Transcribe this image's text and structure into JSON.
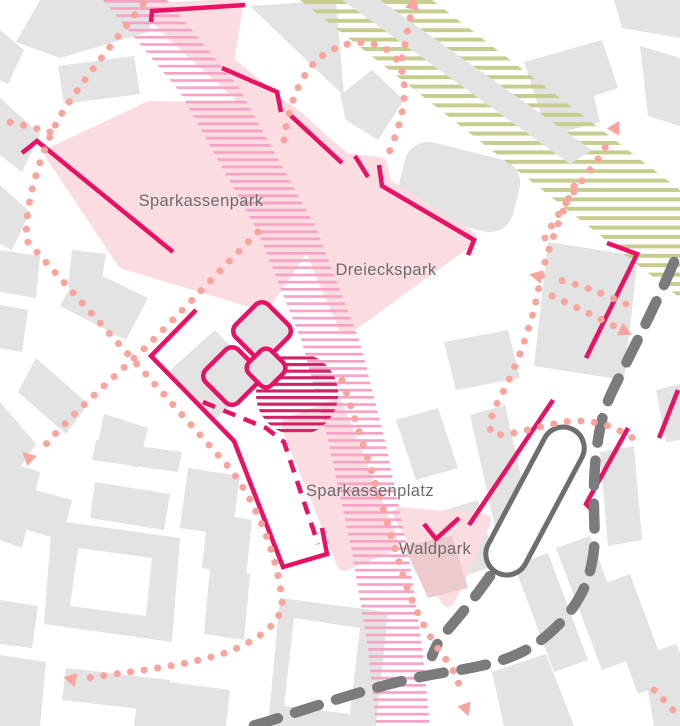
{
  "map": {
    "title": "Urban design site plan",
    "labels": [
      {
        "name": "sparkassenpark-label",
        "text": "Sparkassenpark"
      },
      {
        "name": "dreieckspark-label",
        "text": "Dreieckspark"
      },
      {
        "name": "sparkassenplatz-label",
        "text": "Sparkassenplatz"
      },
      {
        "name": "waldpark-label",
        "text": "Waldpark"
      }
    ],
    "features": {
      "parks": [
        "Sparkassenpark",
        "Dreieckspark",
        "Sparkassenplatz",
        "Waldpark"
      ],
      "pedestrian_band": "pink hatched promenade",
      "rail_band": "olive hatched corridor",
      "tram_platform": "rounded platform outline",
      "transit_route": "gray dashed line",
      "walking_routes": "salmon dotted arrows",
      "active_frontages": "magenta edge lines",
      "pavilions": "three rotated squares",
      "focus_area": "dark pink hatched circle"
    },
    "colors": {
      "building_gray": "#e3e3e4",
      "park_pink": "#fbdce1",
      "waldpark_mauve": "#eccacd",
      "accent_magenta": "#ea1164",
      "hatch_pink": "#f6a3c5",
      "hatch_dark_pink": "#ce2166",
      "hatch_olive": "#c6cd8e",
      "path_salmon": "#f9a59d",
      "road_gray": "#7b7b7b",
      "platform_gray": "#6e6e6e",
      "label_gray": "#6c6c6c"
    }
  }
}
